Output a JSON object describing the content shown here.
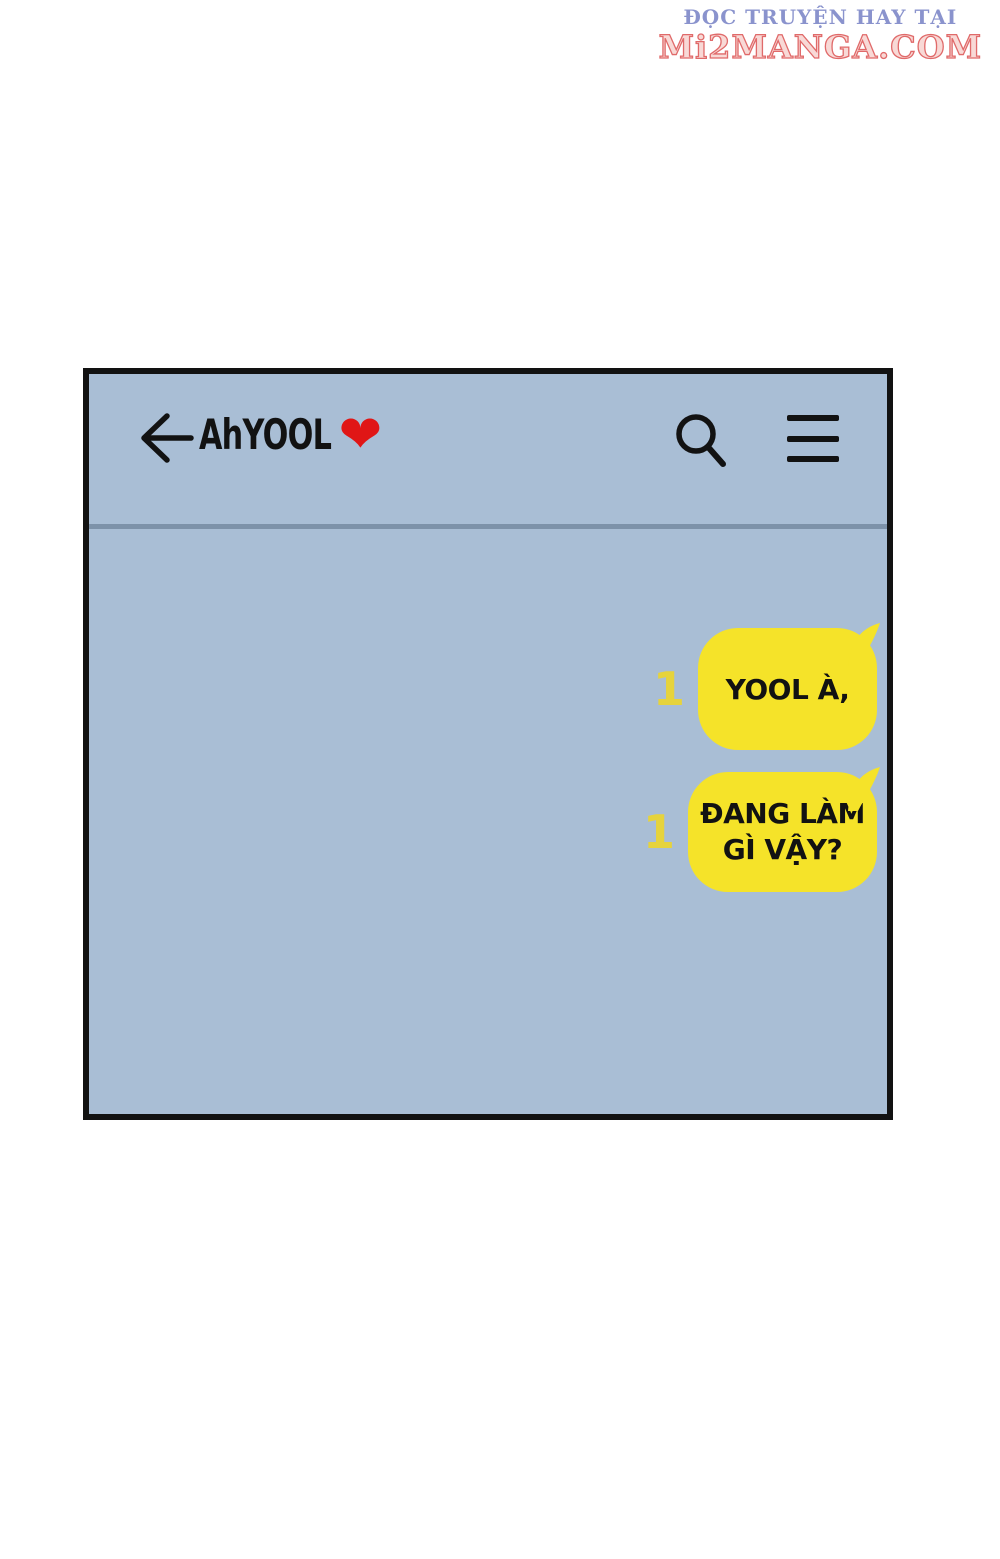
{
  "watermark": {
    "line1": "ĐỌC TRUYỆN HAY TẠI",
    "line2": "Mi2MANGA.COM"
  },
  "chat_header": {
    "title": "AhYOOL",
    "heart": "❤",
    "back_icon": "back-arrow",
    "search_icon": "search",
    "menu_icon": "hamburger-menu"
  },
  "messages": [
    {
      "badge": "1",
      "lines": {
        "0": "YOOL À,"
      }
    },
    {
      "badge": "1",
      "lines": {
        "0": "ĐANG LÀM",
        "1": "GÌ VẬY?"
      }
    }
  ],
  "colors": {
    "bubble": "#f5e329",
    "badge": "#e6d33c",
    "chat_bg": "#a9bed5",
    "divider": "#7d92a9",
    "ink": "#121212",
    "heart_red": "#e01616",
    "watermark_blue": "#8a93cd",
    "watermark_red": "#e06a6a"
  }
}
